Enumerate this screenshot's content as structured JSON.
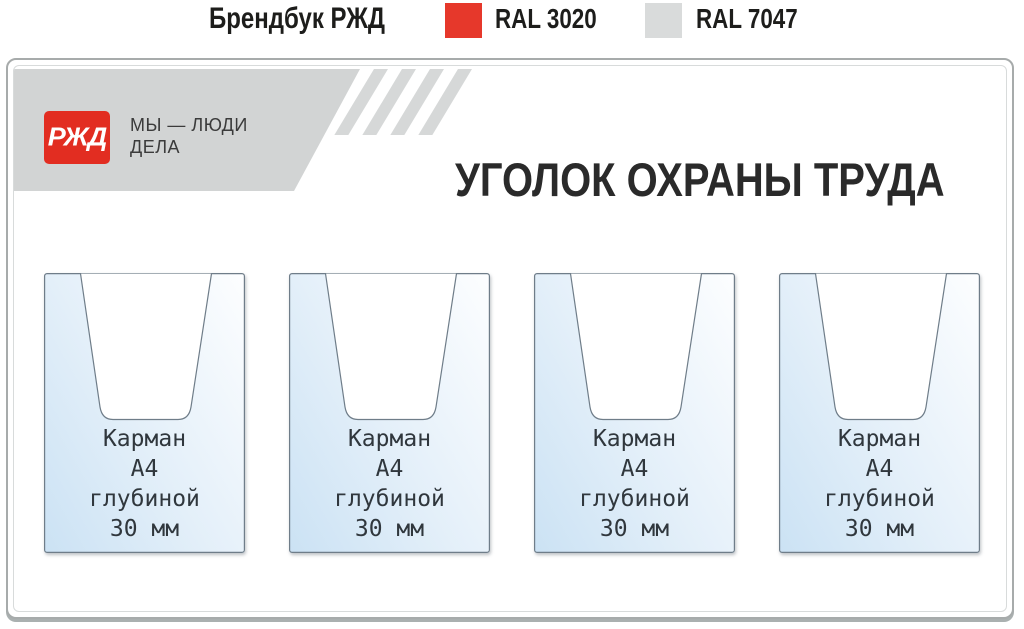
{
  "header": {
    "title": "Брендбук РЖД",
    "ral_red_label": "RAL 3020",
    "ral_gray_label": "RAL 7047"
  },
  "board": {
    "logo": "РЖД",
    "slogan": [
      "МЫ — ЛЮДИ",
      "ДЕЛА"
    ],
    "title": "УГОЛОК ОХРАНЫ ТРУДА",
    "pockets": [
      {
        "lines": [
          "Карман",
          "А4",
          "глубиной",
          "30 мм"
        ]
      },
      {
        "lines": [
          "Карман",
          "А4",
          "глубиной",
          "30 мм"
        ]
      },
      {
        "lines": [
          "Карман",
          "А4",
          "глубиной",
          "30 мм"
        ]
      },
      {
        "lines": [
          "Карман",
          "А4",
          "глубиной",
          "30 мм"
        ]
      }
    ]
  },
  "colors": {
    "ral_3020": "#e6382b",
    "ral_7047": "#d9dbdb",
    "rzd_red": "#e22d21",
    "band_gray": "#d2d4d4",
    "pocket_blue": "#cbe2f4",
    "title_text": "#2a2a2a"
  }
}
